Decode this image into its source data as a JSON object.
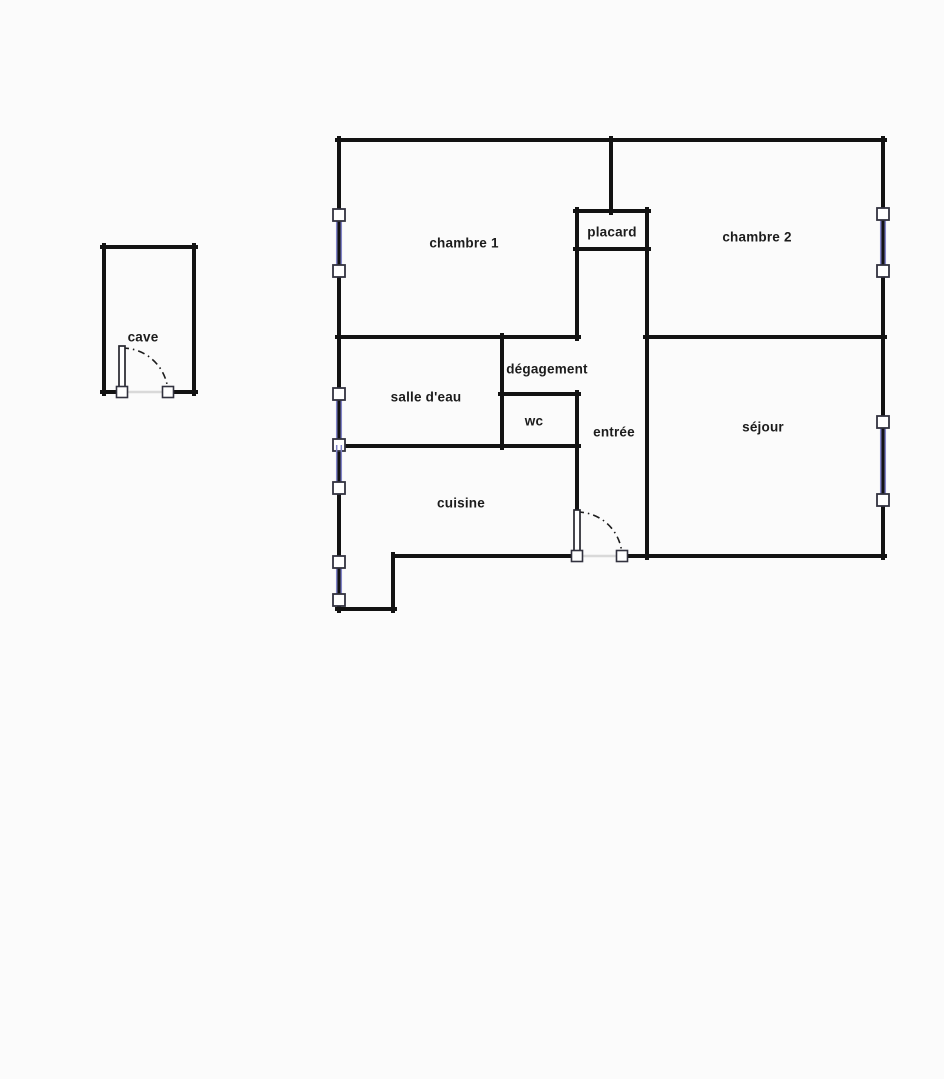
{
  "colors": {
    "background": "#fbfbfb",
    "wall": "#121212",
    "label": "#1c1c1c",
    "window_line": "#8083c8",
    "window_square_border": "#32323f",
    "threshold": "#d9d9d9",
    "door_arc": "#1c1c1c"
  },
  "cave": {
    "label": "cave"
  },
  "rooms": {
    "chambre1": {
      "label": "chambre 1"
    },
    "placard": {
      "label": "placard"
    },
    "chambre2": {
      "label": "chambre 2"
    },
    "degagement": {
      "label": "dégagement"
    },
    "salle_deau": {
      "label": "salle d'eau"
    },
    "wc": {
      "label": "wc"
    },
    "entree": {
      "label": "entrée"
    },
    "sejour": {
      "label": "séjour"
    },
    "cuisine": {
      "label": "cuisine"
    }
  }
}
